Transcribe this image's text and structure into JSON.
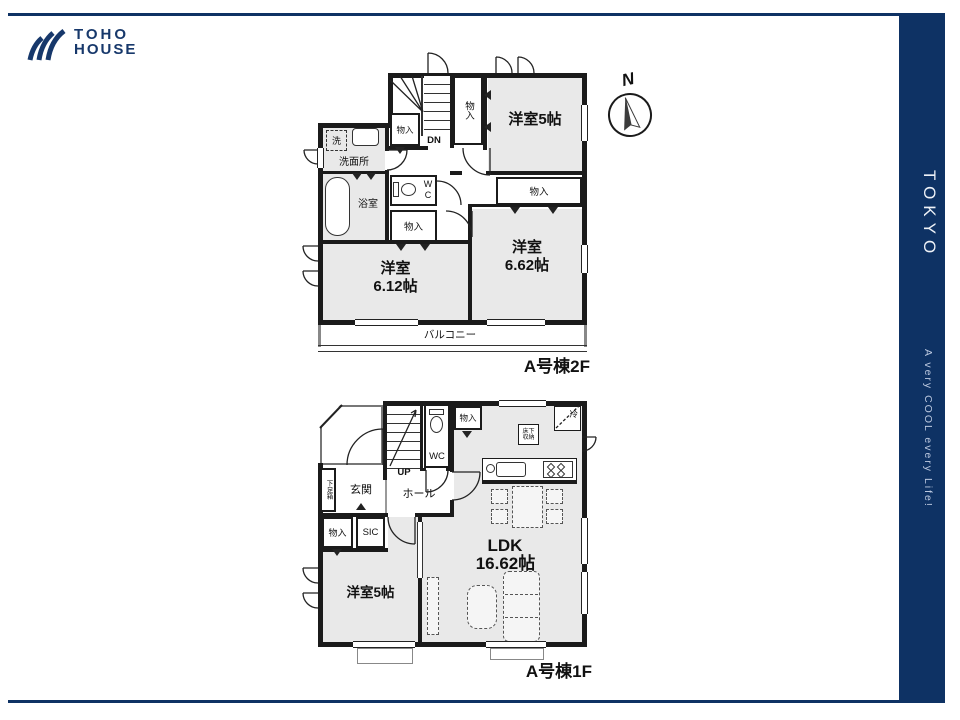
{
  "brand": {
    "line1": "TOHO",
    "line2": "HOUSE"
  },
  "side_banner": {
    "title": "TOKYO",
    "tagline": "A very COOL every Life!"
  },
  "compass": {
    "north": "N"
  },
  "labels": {
    "closet": "物入",
    "wc": "WC",
    "balcony": "バルコニー"
  },
  "floor2": {
    "caption": "A号棟2F",
    "stairs_dir": "DN",
    "bedroom_a": "洋室5帖",
    "bedroom_b_name": "洋室",
    "bedroom_b_size": "6.12帖",
    "bedroom_c_name": "洋室",
    "bedroom_c_size": "6.62帖",
    "washroom": "洗面所",
    "washer": "洗",
    "bath": "浴室"
  },
  "floor1": {
    "caption": "A号棟1F",
    "stairs_dir": "UP",
    "hall": "ホール",
    "entrance": "玄関",
    "shoe_cabinet": "下足箱",
    "sic": "SIC",
    "fridge": "冷",
    "underfloor_1": "床下",
    "underfloor_2": "収納",
    "ldk_name": "LDK",
    "ldk_size": "16.62帖",
    "bedroom": "洋室5帖"
  }
}
